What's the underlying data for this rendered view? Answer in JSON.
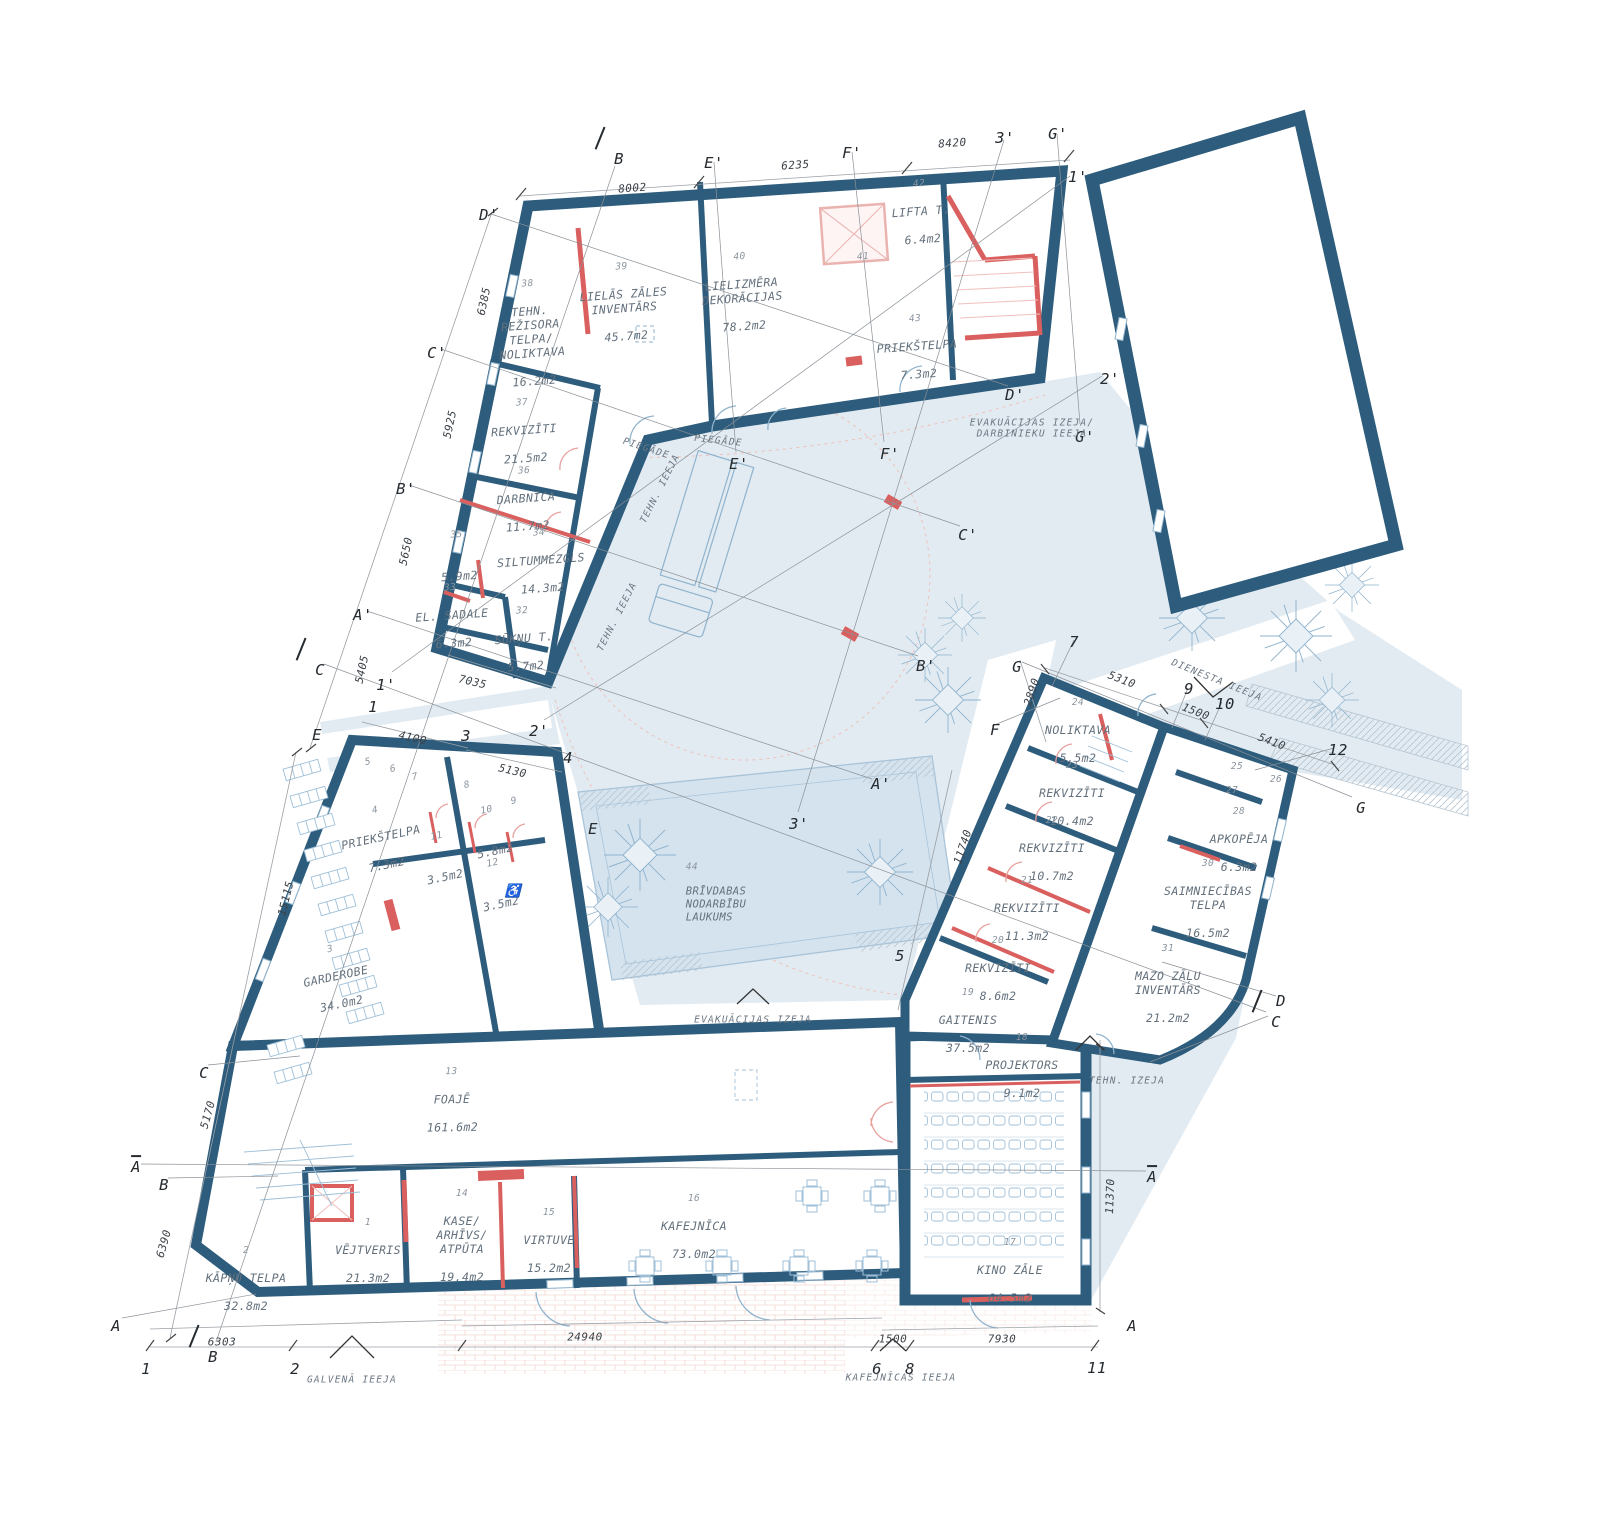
{
  "drawing": {
    "kind": "architectural floor plan",
    "language": "Latvian"
  },
  "colors": {
    "wall": "#2d5c7c",
    "accent_red": "#d9605f",
    "light_red": "#e8a09d",
    "pink": "#f0c0bd",
    "ground_blue": "#e2ebf2",
    "courtyard_blue": "#d5e3ee",
    "pink_paving": "#f9ece9",
    "thin_blue": "#8fb3cd",
    "furniture_blue": "#9fc0d8",
    "dim_line": "#9aa0a6",
    "room_text": "#63707c",
    "dim_text": "#3c4248"
  },
  "rooms": [
    {
      "num": "38",
      "name": "TEHN.\nREŽISORA\nTELPA/\nNOLIKTAVA",
      "area": "16.2m2",
      "x": 531,
      "y": 333,
      "rot": -4
    },
    {
      "num": "39",
      "name": "LIELĀS ZĀLES\nINVENTĀRS",
      "area": "45.7m2",
      "x": 624,
      "y": 302,
      "rot": -4
    },
    {
      "num": "40",
      "name": "LIELIZMĒRA\nDEKORĀCIJAS",
      "area": "78.2m2",
      "x": 742,
      "y": 292,
      "rot": -4
    },
    {
      "num": "41",
      "x": 864,
      "y": 271,
      "rot": -4
    },
    {
      "num": "42",
      "name": "LIFTA T.",
      "area": "6.4m2",
      "x": 921,
      "y": 212,
      "rot": -4
    },
    {
      "num": "43",
      "name": "PRIEKŠTELPA",
      "area": "7.3m2",
      "x": 917,
      "y": 347,
      "rot": -4
    },
    {
      "num": "37",
      "name": "REKVIZĪTI",
      "area": "21.5m2",
      "x": 524,
      "y": 431,
      "rot": -4
    },
    {
      "num": "36",
      "name": "DARBNĪCA",
      "area": "11.7m2",
      "x": 526,
      "y": 499,
      "rot": -4
    },
    {
      "num": "35",
      "area": "5.9m2",
      "x": 458,
      "y": 556,
      "rot": -4
    },
    {
      "num": "34",
      "name": "SILTUMMEZGLS",
      "area": "14.3m2",
      "x": 541,
      "y": 561,
      "rot": -4
    },
    {
      "num": "33",
      "name": "EL. SADALE",
      "area": "6.3m2",
      "x": 452,
      "y": 616,
      "rot": -4
    },
    {
      "num": "32",
      "name": "SŪKŅU T.",
      "area": "5.7m2",
      "x": 524,
      "y": 639,
      "rot": -4
    },
    {
      "num": "44",
      "name": "BRĪVDABAS\nNODARBĪBU\nLAUKUMS",
      "x": 716,
      "y": 899,
      "cls": "align-left"
    },
    {
      "num": "24",
      "name": "NOLIKTAVA",
      "area": "5.5m2",
      "x": 1078,
      "y": 731
    },
    {
      "num": "23",
      "name": "REKVIZĪTI",
      "area": "10.4m2",
      "x": 1072,
      "y": 794
    },
    {
      "num": "22",
      "name": "REKVIZĪTI",
      "area": "10.7m2",
      "x": 1052,
      "y": 849
    },
    {
      "num": "21",
      "name": "REKVIZĪTI",
      "area": "11.3m2",
      "x": 1027,
      "y": 909
    },
    {
      "num": "20",
      "name": "REKVIZĪTI",
      "area": "8.6m2",
      "x": 998,
      "y": 969
    },
    {
      "num": "19",
      "name": "GAITENIS",
      "area": "37.5m2",
      "x": 968,
      "y": 1021
    },
    {
      "num": "18",
      "name": "PROJEKTORS",
      "area": "9.1m2",
      "x": 1022,
      "y": 1066
    },
    {
      "num": "17",
      "name": "KINO ZĀLE",
      "area": "64.5m2",
      "x": 1010,
      "y": 1271
    },
    {
      "num": "25",
      "x": 1237,
      "y": 781
    },
    {
      "num": "26",
      "x": 1276,
      "y": 794
    },
    {
      "num": "27",
      "x": 1232,
      "y": 805
    },
    {
      "num": "28",
      "name": "APKOPĒJA",
      "area": "6.3m2",
      "x": 1239,
      "y": 840
    },
    {
      "num": "30",
      "name": "SAIMNIECĪBAS\nTELPA",
      "area": "16.5m2",
      "x": 1208,
      "y": 899
    },
    {
      "num": "31",
      "name": "MAZO ZĀĻU\nINVENTĀRS",
      "area": "21.2m2",
      "x": 1168,
      "y": 984
    },
    {
      "num": "13",
      "name": "FOAJĒ",
      "area": "161.6m2",
      "x": 452,
      "y": 1100,
      "rot": -1
    },
    {
      "num": "14",
      "name": "KASE/\nARHĪVS/\nATPŪTA",
      "area": "19.4m2",
      "x": 462,
      "y": 1236
    },
    {
      "num": "15",
      "name": "VIRTUVE",
      "area": "15.2m2",
      "x": 549,
      "y": 1241
    },
    {
      "num": "16",
      "name": "KAFEJNĪCA",
      "area": "73.0m2",
      "x": 694,
      "y": 1227
    },
    {
      "num": "1",
      "name": "VĒJTVERIS",
      "area": "21.3m2",
      "x": 368,
      "y": 1251
    },
    {
      "num": "2",
      "name": "KĀPŅU TELPA",
      "area": "32.8m2",
      "x": 246,
      "y": 1279
    },
    {
      "num": "3",
      "name": "GARDEROBE",
      "area": "34.0m2",
      "x": 336,
      "y": 977,
      "rot": -12
    },
    {
      "num": "4",
      "name": "PRIEKŠTELPA",
      "area": "7.3m2",
      "x": 381,
      "y": 838,
      "rot": -12
    },
    {
      "num": "10",
      "area": "5.8m2",
      "x": 491,
      "y": 831,
      "rot": -12
    },
    {
      "num": "11",
      "area": "3.5m2",
      "x": 441,
      "y": 857,
      "rot": -12
    },
    {
      "num": "12",
      "area": "3.5m2",
      "x": 497,
      "y": 884,
      "rot": -12
    },
    {
      "num": "5",
      "x": 371,
      "y": 776,
      "rot": -12
    },
    {
      "num": "6",
      "x": 396,
      "y": 783,
      "rot": -12
    },
    {
      "num": "7",
      "x": 418,
      "y": 791,
      "rot": -12
    },
    {
      "num": "8",
      "x": 470,
      "y": 799,
      "rot": -12
    },
    {
      "num": "9",
      "x": 517,
      "y": 815,
      "rot": -12
    }
  ],
  "dimensions": [
    {
      "text": "8002",
      "x": 632,
      "y": 182,
      "rot": -4
    },
    {
      "text": "6235",
      "x": 795,
      "y": 159,
      "rot": -4
    },
    {
      "text": "8420",
      "x": 952,
      "y": 137,
      "rot": -4
    },
    {
      "text": "6385",
      "x": 478,
      "y": 300,
      "rot": -78
    },
    {
      "text": "5925",
      "x": 444,
      "y": 423,
      "rot": -78
    },
    {
      "text": "5650",
      "x": 400,
      "y": 550,
      "rot": -78
    },
    {
      "text": "5405",
      "x": 356,
      "y": 668,
      "rot": -78
    },
    {
      "text": "7035",
      "x": 474,
      "y": 676,
      "rot": 13
    },
    {
      "text": "4100",
      "x": 414,
      "y": 732,
      "rot": 13
    },
    {
      "text": "5130",
      "x": 514,
      "y": 765,
      "rot": 13
    },
    {
      "text": "15115",
      "x": 280,
      "y": 897,
      "rot": -76
    },
    {
      "text": "5170",
      "x": 202,
      "y": 1113,
      "rot": -74
    },
    {
      "text": "6390",
      "x": 158,
      "y": 1242,
      "rot": -74
    },
    {
      "text": "6303",
      "x": 222,
      "y": 1336,
      "rot": 0
    },
    {
      "text": "24940",
      "x": 585,
      "y": 1331,
      "rot": 0
    },
    {
      "text": "1500",
      "x": 893,
      "y": 1333,
      "rot": 0
    },
    {
      "text": "7930",
      "x": 1002,
      "y": 1333,
      "rot": 0
    },
    {
      "text": "11370",
      "x": 1104,
      "y": 1196,
      "rot": -88
    },
    {
      "text": "11740",
      "x": 957,
      "y": 845,
      "rot": -72
    },
    {
      "text": "2890",
      "x": 1026,
      "y": 690,
      "rot": -72
    },
    {
      "text": "5310",
      "x": 1124,
      "y": 674,
      "rot": 21
    },
    {
      "text": "1500",
      "x": 1198,
      "y": 706,
      "rot": 21
    },
    {
      "text": "5410",
      "x": 1274,
      "y": 736,
      "rot": 21
    }
  ],
  "grid_labels": [
    {
      "text": "B",
      "x": 619,
      "y": 150,
      "cls": "slash"
    },
    {
      "text": "E'",
      "x": 714,
      "y": 154
    },
    {
      "text": "F'",
      "x": 852,
      "y": 144
    },
    {
      "text": "3'",
      "x": 1005,
      "y": 129
    },
    {
      "text": "G'",
      "x": 1058,
      "y": 125
    },
    {
      "text": "1'",
      "x": 1078,
      "y": 168
    },
    {
      "text": "D'",
      "x": 489,
      "y": 206
    },
    {
      "text": "C'",
      "x": 437,
      "y": 344
    },
    {
      "text": "B'",
      "x": 406,
      "y": 480
    },
    {
      "text": "A'",
      "x": 363,
      "y": 606
    },
    {
      "text": "C",
      "x": 320,
      "y": 661,
      "cls": "slash"
    },
    {
      "text": "1'",
      "x": 386,
      "y": 676
    },
    {
      "text": "1",
      "x": 373,
      "y": 698
    },
    {
      "text": "E",
      "x": 317,
      "y": 726
    },
    {
      "text": "3",
      "x": 466,
      "y": 727
    },
    {
      "text": "2'",
      "x": 539,
      "y": 722
    },
    {
      "text": "4",
      "x": 568,
      "y": 749
    },
    {
      "text": "E",
      "x": 593,
      "y": 820
    },
    {
      "text": "3'",
      "x": 799,
      "y": 815
    },
    {
      "text": "A'",
      "x": 881,
      "y": 775
    },
    {
      "text": "5",
      "x": 900,
      "y": 947
    },
    {
      "text": "B'",
      "x": 926,
      "y": 657
    },
    {
      "text": "C'",
      "x": 968,
      "y": 526
    },
    {
      "text": "E'",
      "x": 739,
      "y": 455
    },
    {
      "text": "F'",
      "x": 890,
      "y": 445
    },
    {
      "text": "D'",
      "x": 1015,
      "y": 386
    },
    {
      "text": "G'",
      "x": 1085,
      "y": 428
    },
    {
      "text": "2'",
      "x": 1110,
      "y": 370
    },
    {
      "text": "7",
      "x": 1074,
      "y": 633
    },
    {
      "text": "G",
      "x": 1017,
      "y": 658
    },
    {
      "text": "9",
      "x": 1189,
      "y": 680
    },
    {
      "text": "10",
      "x": 1225,
      "y": 695
    },
    {
      "text": "12",
      "x": 1338,
      "y": 741
    },
    {
      "text": "G",
      "x": 1361,
      "y": 799
    },
    {
      "text": "F",
      "x": 995,
      "y": 721
    },
    {
      "text": "D",
      "x": 1281,
      "y": 992
    },
    {
      "text": "C",
      "x": 1276,
      "y": 1013,
      "cls": "slash"
    },
    {
      "text": "C",
      "x": 204,
      "y": 1064
    },
    {
      "text": "B",
      "x": 164,
      "y": 1176
    },
    {
      "text": "A",
      "x": 116,
      "y": 1317
    },
    {
      "text": "A",
      "x": 136,
      "y": 1158,
      "cls": "ovl"
    },
    {
      "text": "A",
      "x": 1152,
      "y": 1168,
      "cls": "ovl"
    },
    {
      "text": "1",
      "x": 146,
      "y": 1360
    },
    {
      "text": "2",
      "x": 295,
      "y": 1360
    },
    {
      "text": "B",
      "x": 213,
      "y": 1348,
      "cls": "slash"
    },
    {
      "text": "6",
      "x": 877,
      "y": 1360
    },
    {
      "text": "8",
      "x": 910,
      "y": 1360
    },
    {
      "text": "11",
      "x": 1097,
      "y": 1359
    },
    {
      "text": "A",
      "x": 1132,
      "y": 1317
    }
  ],
  "entrances": [
    {
      "text": "GALVENĀ IEEJA",
      "x": 352,
      "y": 1374
    },
    {
      "text": "KAFEJNĪCAS IEEJA",
      "x": 901,
      "y": 1372
    },
    {
      "text": "DIENESTA IEEJA",
      "x": 1219,
      "y": 675,
      "rot": 22
    },
    {
      "text": "TEHN. IZEJA",
      "x": 1127,
      "y": 1075
    },
    {
      "text": "EVAKUĀCIJAS IZEJA",
      "x": 753,
      "y": 1014
    },
    {
      "text": "EVAKUĀCIJAS IZEJA/\nDARBINIEKU IEEJA",
      "x": 1032,
      "y": 423
    },
    {
      "text": "PIEGĀDE",
      "x": 648,
      "y": 443,
      "rot": 18
    },
    {
      "text": "PIEGĀDE",
      "x": 719,
      "y": 435,
      "rot": 6
    },
    {
      "text": "TEHN. IEEJA",
      "x": 655,
      "y": 486,
      "rot": -63
    },
    {
      "text": "TEHN. IEEJA",
      "x": 612,
      "y": 614,
      "rot": -63
    },
    {
      "text": "♿",
      "x": 513,
      "y": 884,
      "cls": "wc"
    }
  ]
}
